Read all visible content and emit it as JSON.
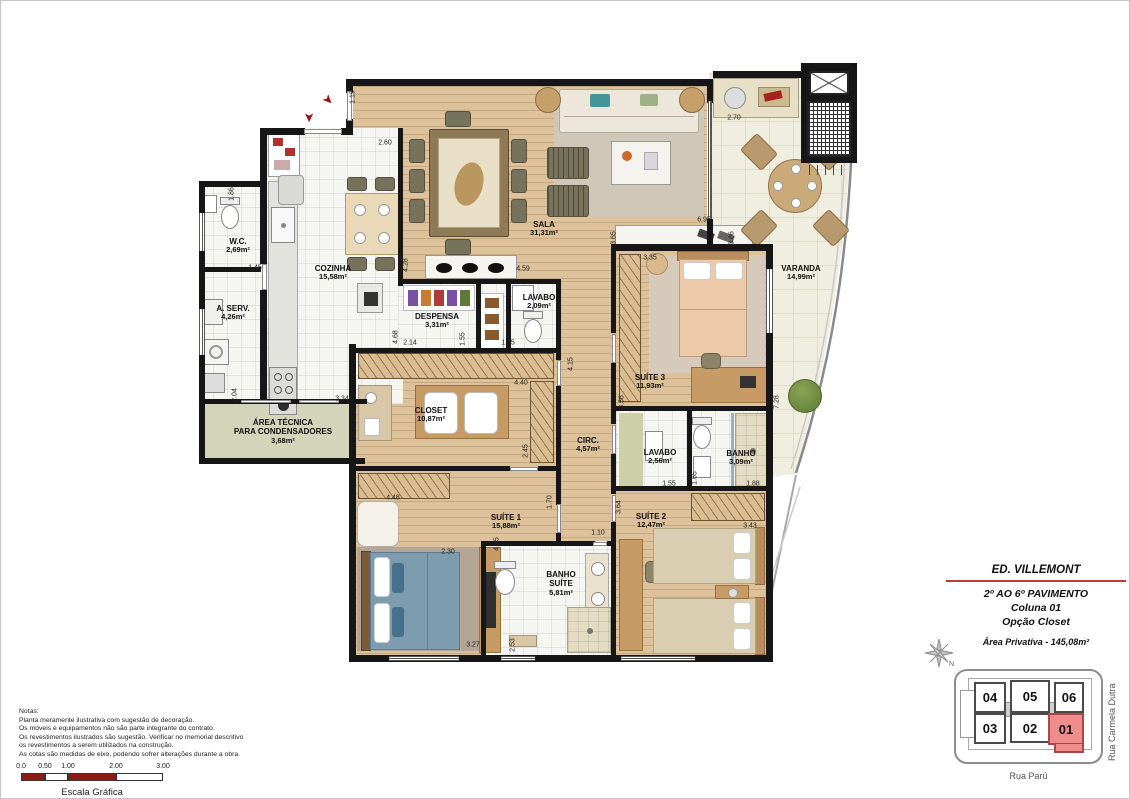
{
  "title_block": {
    "building_name": "ED. VILLEMONT",
    "floor_range": "2º AO 6º PAVIMENTO",
    "column": "Coluna 01",
    "option": "Opção Closet",
    "private_area": "Área Privativa - 145,08m²"
  },
  "compass": {
    "north_label": "N"
  },
  "key_plan": {
    "units": {
      "u04": "04",
      "u05": "05",
      "u06": "06",
      "u03": "03",
      "u02": "02",
      "u01": "01"
    },
    "highlighted_unit": "01",
    "street_right": "Rua Carmela Dutra",
    "street_bottom": "Rua Parú"
  },
  "notes": {
    "heading": "Notas:",
    "line1": "Planta meramente ilustrativa com sugestão de decoração.",
    "line2": "Os móveis e equipamentos não são parte integrante do contrato.",
    "line3": "Os revestimentos ilustrados são sugestão. Verificar no memorial descritivo",
    "line4": "os revestimentos a serem utilizados na construção.",
    "line5": "As cotas são medidas de eixo, podendo sofrer alterações durante a obra."
  },
  "scale_bar": {
    "t0": "0.0",
    "t1": "0.50",
    "t2": "1.00",
    "t3": "2.00",
    "t4": "3.00",
    "caption": "Escala Gráfica"
  },
  "icons": {
    "entry_arrow": "➤"
  },
  "rooms": {
    "sala": {
      "name": "SALA",
      "area": "31,31m²"
    },
    "varanda": {
      "name": "VARANDA",
      "area": "14,99m²"
    },
    "cozinha": {
      "name": "COZINHA",
      "area": "15,58m²"
    },
    "wc": {
      "name": "W.C.",
      "area": "2,69m²"
    },
    "area_servico": {
      "name": "A. SERV.",
      "area": "4,26m²"
    },
    "despensa": {
      "name": "DESPENSA",
      "area": "3,31m²"
    },
    "lavabo": {
      "name": "LAVABO",
      "area": "2,09m²"
    },
    "suite3": {
      "name": "SUÍTE 3",
      "area": "11,93m²"
    },
    "closet": {
      "name": "CLOSET",
      "area": "10,87m²"
    },
    "circulacao": {
      "name": "CIRC.",
      "area": "4,57m²"
    },
    "lavabo2": {
      "name": "LAVABO",
      "area": "2,56m²"
    },
    "banho": {
      "name": "BANHO",
      "area": "3,09m²"
    },
    "suite1": {
      "name": "SUÍTE 1",
      "area": "15,88m²"
    },
    "banho_suite": {
      "name": "BANHO SUÍTE",
      "area": "5,81m²"
    },
    "suite2": {
      "name": "SUÍTE 2",
      "area": "12,47m²"
    },
    "area_tecnica": {
      "name": "ÁREA TÉCNICA",
      "name2": "PARA CONDENSADORES",
      "area": "3,68m²"
    }
  },
  "dims": {
    "d01": "1.15",
    "d02": "2.60",
    "d03": "1.86",
    "d04": "1.45",
    "d05": "4.28",
    "d06": "4.59",
    "d07": "2.14",
    "d08": "4.68",
    "d09": "1.55",
    "d10": "1.35",
    "d11": "2.70",
    "d12": "6.95",
    "d13": "3.65",
    "d14": "3.66",
    "d15": "3.35",
    "d16": "4.40",
    "d17": "2.45",
    "d18": "4.15",
    "d19": "3.56",
    "d20": "1.65",
    "d21": "1.55",
    "d22": "1.88",
    "d23": "7.28",
    "d24": "3.43",
    "d25": "4.48",
    "d26": "1.70",
    "d27": "3.64",
    "d28": "1.10",
    "d29": "4.15",
    "d30": "2.30",
    "d31": "2.53",
    "d32": "3.27",
    "d33": "2.04",
    "d34": "3.34"
  },
  "colors": {
    "accent_red": "#9e1217",
    "unit_highlight": "#ef8d8d",
    "wall_black": "#161616",
    "wood_floor": "#dcc19a"
  }
}
